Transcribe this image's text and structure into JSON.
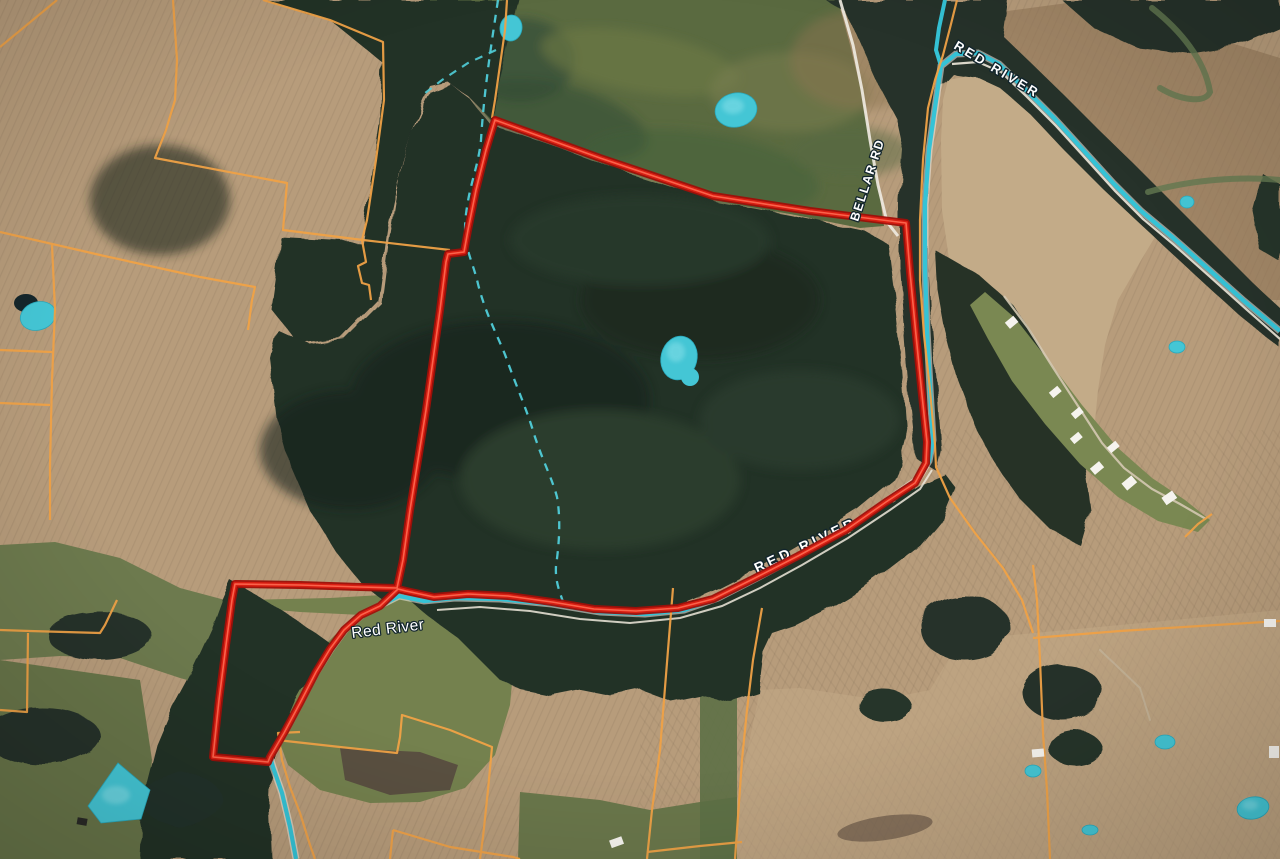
{
  "map": {
    "type": "satellite-parcel-map",
    "labels": {
      "river_upper": "RED RIVER",
      "road": "BELLAR RD",
      "river_mid": "RED RIVER",
      "river_lower": "Red River"
    },
    "colors": {
      "property_boundary": "#d81e12",
      "parcel_lines": "#f0a246",
      "water": "#3cc8da",
      "road": "#efece4",
      "forest": "#243128",
      "field_tan": "#b79c7b"
    },
    "features": [
      "property-boundary",
      "parcel-boundaries",
      "red-river",
      "bellar-road",
      "ponds",
      "intermittent-creek",
      "farm-buildings"
    ]
  }
}
